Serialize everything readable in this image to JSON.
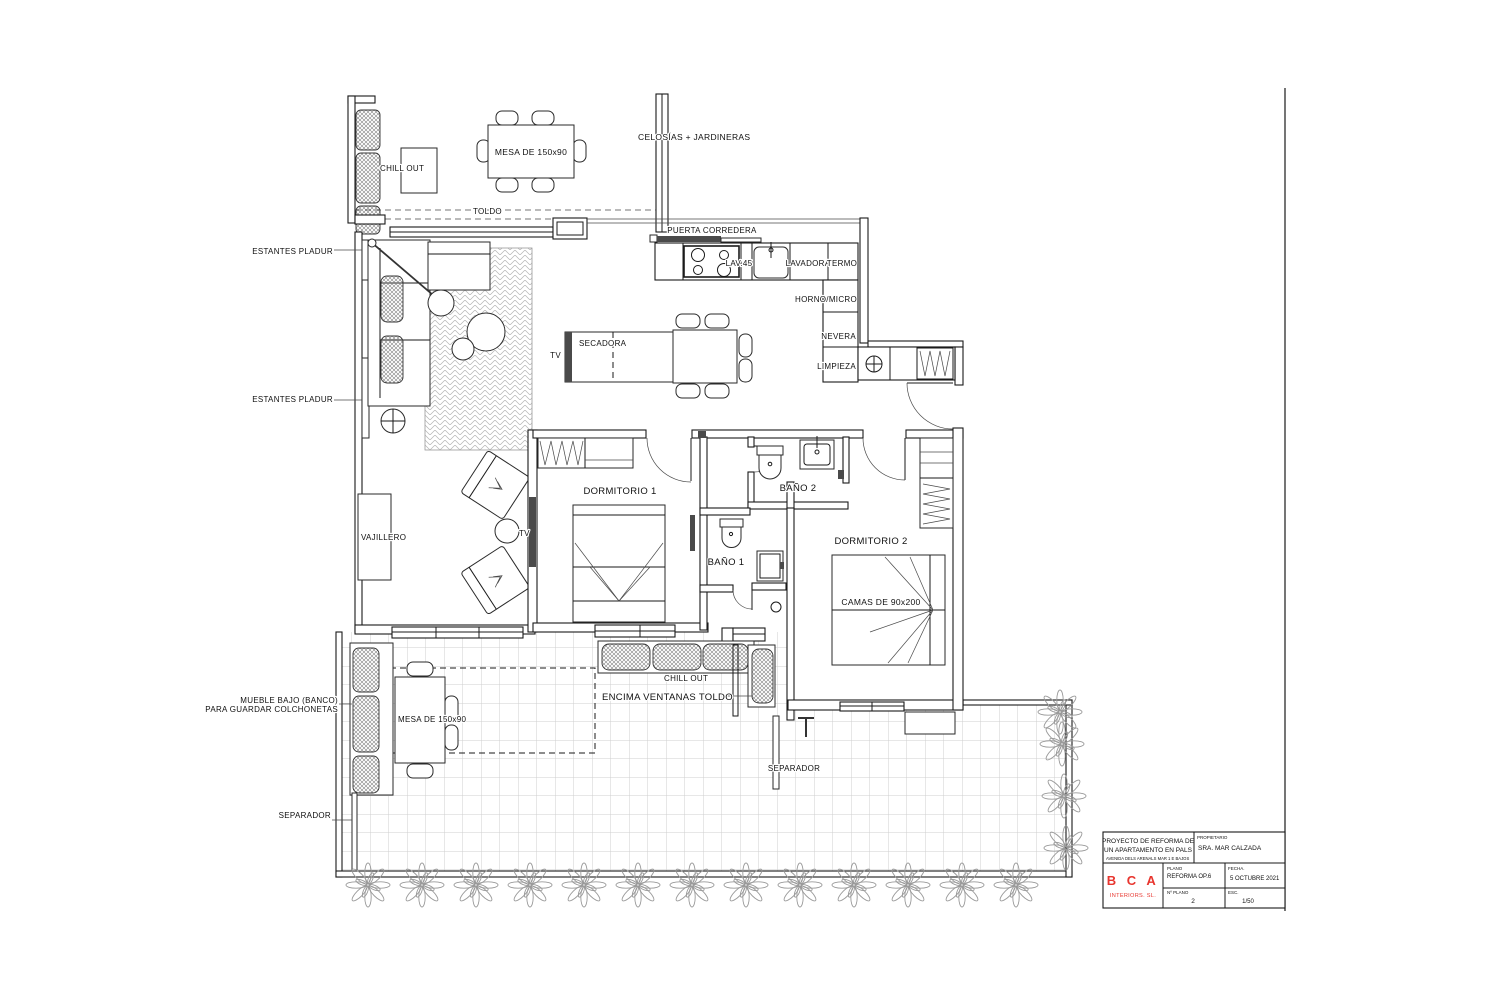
{
  "colors": {
    "line": "#1a1a1a",
    "brand_red": "#e8352e"
  },
  "plan": {
    "terrace_top": {
      "chill_out": "CHILL OUT",
      "mesa": "MESA DE 150x90",
      "celosias": "CELOSÍAS + JARDINERAS",
      "toldo": "TOLDO",
      "puerta_corredera": "PUERTA CORREDERA"
    },
    "kitchen": {
      "lav": "LAV.45",
      "lavadora": "LAVADORA",
      "termo": "TERMO",
      "horno": "HORNO/MICRO",
      "nevera": "NEVERA",
      "limpieza": "LIMPIEZA"
    },
    "living": {
      "estantes_1": "ESTANTES PLADUR",
      "estantes_2": "ESTANTES PLADUR",
      "secadora": "SECADORA",
      "tv_island": "TV",
      "tv_lounge": "TV",
      "vajillero": "VAJILLERO"
    },
    "bedrooms": {
      "dorm1": "DORMITORIO 1",
      "bano2": "BAÑO 2",
      "bano1": "BAÑO 1",
      "dorm2": "DORMITORIO 2",
      "camas": "CAMAS DE 90x200"
    },
    "terrace_bottom": {
      "mueble_line1": "MUEBLE BAJO (BANCO)",
      "mueble_line2": "PARA GUARDAR COLCHONETAS",
      "mesa": "MESA DE 150x90",
      "chill_out": "CHILL OUT",
      "encima": "ENCIMA VENTANAS TOLDO",
      "separador_left": "SEPARADOR",
      "separador_right": "SEPARADOR"
    }
  },
  "title_block": {
    "project_line1": "PROYECTO DE REFORMA DE",
    "project_line2": "UN APARTAMENTO EN PALS",
    "address": "AVENIDA DELS ARENALS MAR 1 E BAJOS",
    "owner_label": "PROPIETARIO",
    "owner": "SRA. MAR CALZADA",
    "plano_label": "PLANO",
    "plano": "REFORMA OP.6",
    "fecha_label": "FECHA.",
    "fecha": "5 OCTUBRE 2021",
    "num_label": "Nº PLANO",
    "num": "2",
    "esc_label": "ESC.",
    "esc": "1/50",
    "firm_name": "B C A",
    "firm_sub": "INTERIORS. SL."
  }
}
